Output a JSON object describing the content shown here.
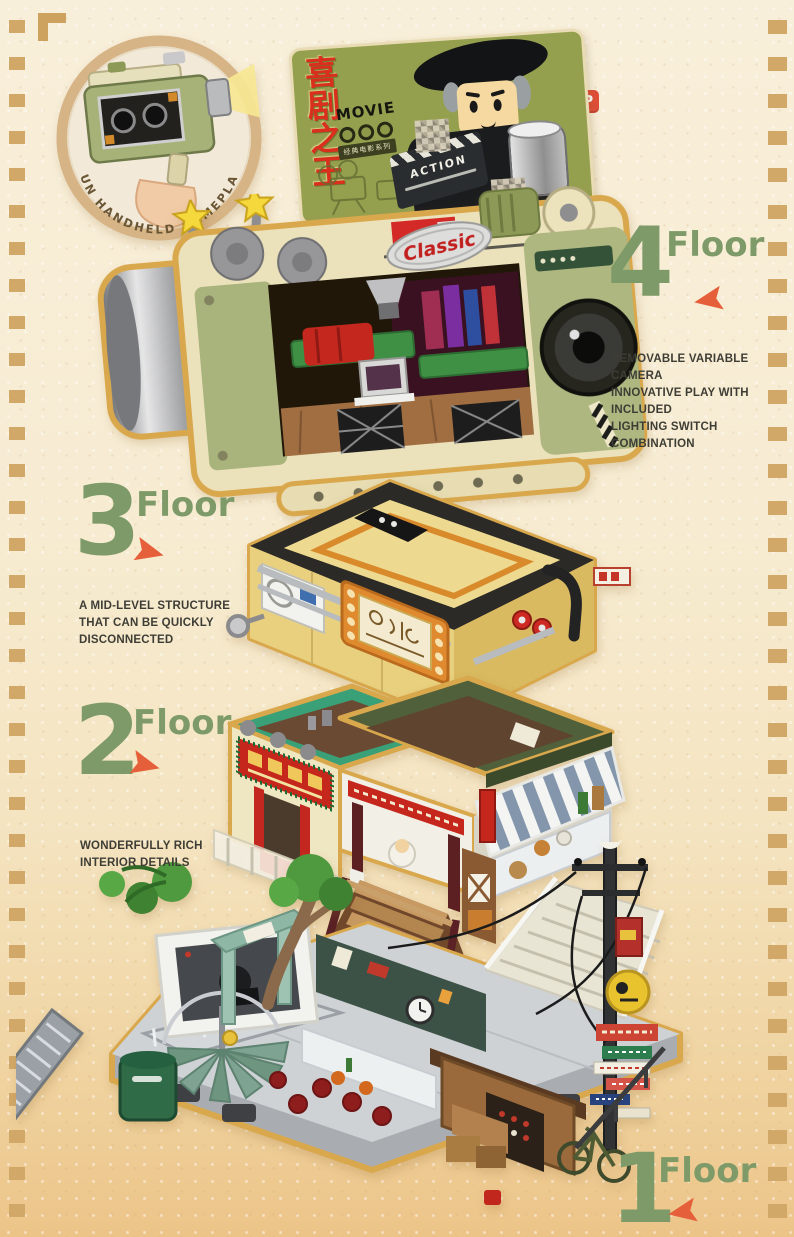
{
  "top_marker": {
    "label": "TOP"
  },
  "inset": {
    "caption": "FUN HANDHELD GAMEPLAY"
  },
  "billboard": {
    "title": "喜剧之王",
    "logo": "MOVIE",
    "series": "经典电影系列",
    "clapperboard": "ACTION"
  },
  "camera": {
    "badge": "Classic"
  },
  "floors": [
    {
      "id": "floor-4",
      "number": "4",
      "label": "Floor",
      "arrow_direction": "left",
      "desc_lines": [
        "REMOVABLE VARIABLE CAMERA",
        "INNOVATIVE PLAY WITH INCLUDED",
        "LIGHTING SWITCH COMBINATION"
      ]
    },
    {
      "id": "floor-3",
      "number": "3",
      "label": "Floor",
      "arrow_direction": "right",
      "desc_lines": [
        "A MID-LEVEL STRUCTURE",
        "THAT CAN BE QUICKLY",
        "DISCONNECTED"
      ]
    },
    {
      "id": "floor-2",
      "number": "2",
      "label": "Floor",
      "arrow_direction": "right",
      "desc_lines": [
        "WONDERFULLY RICH",
        "INTERIOR DETAILS"
      ]
    },
    {
      "id": "floor-1",
      "number": "1",
      "label": "Floor",
      "arrow_direction": "left",
      "desc_lines": []
    }
  ],
  "colors": {
    "background_top": "#f8efda",
    "background_bottom": "#ecc488",
    "film_perforation": "#d2a868",
    "heading_green": "#7d9a68",
    "arrow_red": "#e5603a",
    "badge_red": "#e04e38",
    "billboard_green": "#95a04f",
    "camera_cream": "#ebe2bc",
    "camera_olive": "#a9b37c",
    "floor3_yellow": "#e8cf7d",
    "floor2_teal_roof": "#3aa077",
    "floor2_olive_roof": "#50603a",
    "floor1_gray": "#c7cbce",
    "gold_outline": "#d9a84c"
  }
}
